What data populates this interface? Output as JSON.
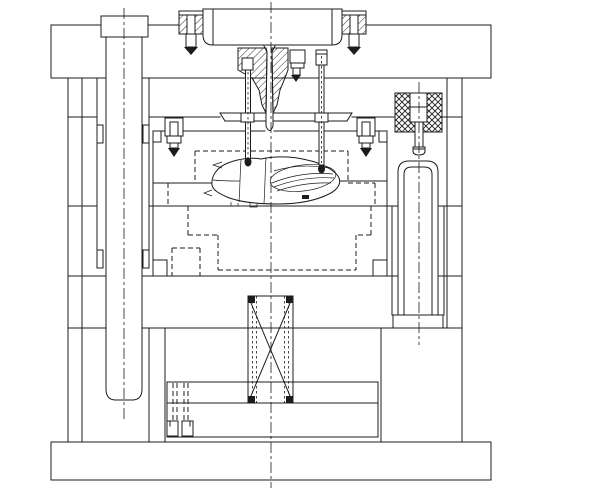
{
  "drawing": {
    "title": "Injection mould assembly - sectional view",
    "description": "Black-and-white CAD cross-section of a two-plate injection mould: locating ring and sprue bushing at top, cavity and core plates with a moulded shell part at the parting line, guide pillars left and right, return spring and ejector plates at the bottom.",
    "canvas": {
      "width": 600,
      "height": 492
    },
    "colors": {
      "line": "#1c1c1c",
      "background": "#ffffff",
      "fill": "#ffffff"
    },
    "line_styles": {
      "visible": "solid",
      "hidden": "dashed 5/3",
      "centerline": "long-dash-dot",
      "section": "45-degree hatch",
      "spring_block": "cross hatch"
    },
    "components": [
      {
        "id": "locating-ring",
        "label": "Locating ring"
      },
      {
        "id": "ring-screw-left",
        "label": "Socket head cap screw (left)"
      },
      {
        "id": "ring-screw-right",
        "label": "Socket head cap screw (right)"
      },
      {
        "id": "sprue-bushing",
        "label": "Sprue bushing (sectioned)"
      },
      {
        "id": "top-clamp-plate",
        "label": "Top clamp plate"
      },
      {
        "id": "fixed-support-plate",
        "label": "Fixed-half backing plate"
      },
      {
        "id": "cavity-plate",
        "label": "Cavity plate (A plate)"
      },
      {
        "id": "core-plate",
        "label": "Core plate (B plate)"
      },
      {
        "id": "support-plate",
        "label": "Support plate"
      },
      {
        "id": "spacer-rail-left",
        "label": "Spacer block (left)"
      },
      {
        "id": "spacer-rail-right",
        "label": "Spacer block (right)"
      },
      {
        "id": "bottom-clamp-plate",
        "label": "Bottom clamp plate"
      },
      {
        "id": "ejector-retainer-plate",
        "label": "Ejector retainer plate"
      },
      {
        "id": "ejector-base-plate",
        "label": "Ejector base plate"
      },
      {
        "id": "guide-pillar-left",
        "label": "Guide pillar with bushing (left)"
      },
      {
        "id": "ejector-guide-pillar",
        "label": "Ejector-half guide pillar (right)"
      },
      {
        "id": "spring-loaded-puller",
        "label": "Spring-loaded puller pin (cross-hatched spring)"
      },
      {
        "id": "return-spring",
        "label": "Return spring (crossed-box symbol)"
      },
      {
        "id": "molded-part",
        "label": "Moulded shell part in cavity"
      },
      {
        "id": "core-pin-left",
        "label": "Core pin (left)"
      },
      {
        "id": "core-pin-right",
        "label": "Core pin (right)"
      },
      {
        "id": "sprue-side-screw",
        "label": "Cap screw beside sprue bushing"
      },
      {
        "id": "plate-screw-left",
        "label": "Cap screw at cavity plate (left)"
      },
      {
        "id": "plate-screw-right",
        "label": "Cap screw at cavity plate (right)"
      },
      {
        "id": "cavity-insert-hidden",
        "label": "Cavity insert (hidden, dashed)"
      },
      {
        "id": "core-insert-hidden",
        "label": "Core insert (hidden, dashed)"
      },
      {
        "id": "ejector-plate-screw",
        "label": "Ejector plate screw (hidden)"
      }
    ]
  }
}
